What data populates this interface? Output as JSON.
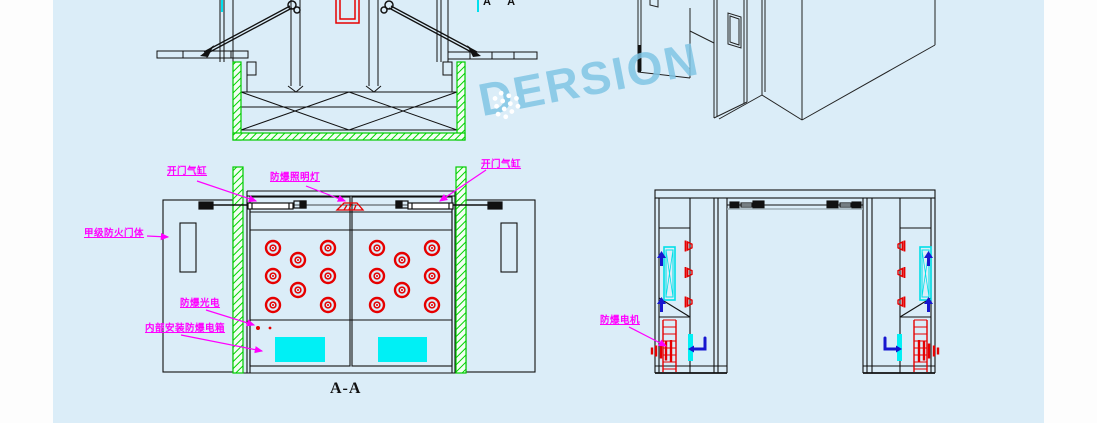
{
  "page": {
    "background": "#fdfdfd",
    "canvas_color": "#dbedf8"
  },
  "watermark": {
    "text": "DERSION",
    "color": "#80c4e4"
  },
  "section_view": {
    "caption": "A-A",
    "cut_marker": "A A"
  },
  "annotations": {
    "door_cylinder_left": "开门气缸",
    "lamp": "防爆照明灯",
    "door_cylinder_right": "开门气缸",
    "fire_door": "甲级防火门体",
    "photocell": "防爆光电",
    "electric_box": "内部安装防爆电箱",
    "motor": "防爆电机"
  },
  "colors": {
    "line": "#111111",
    "wall_hatch_green": "#00d400",
    "nozzle_red": "#e60000",
    "annotation_magenta": "#ff00ff",
    "cyan_fill": "#00f0f5",
    "arrow_blue": "#1717cf",
    "watermark_blue": "#80c4e4"
  }
}
